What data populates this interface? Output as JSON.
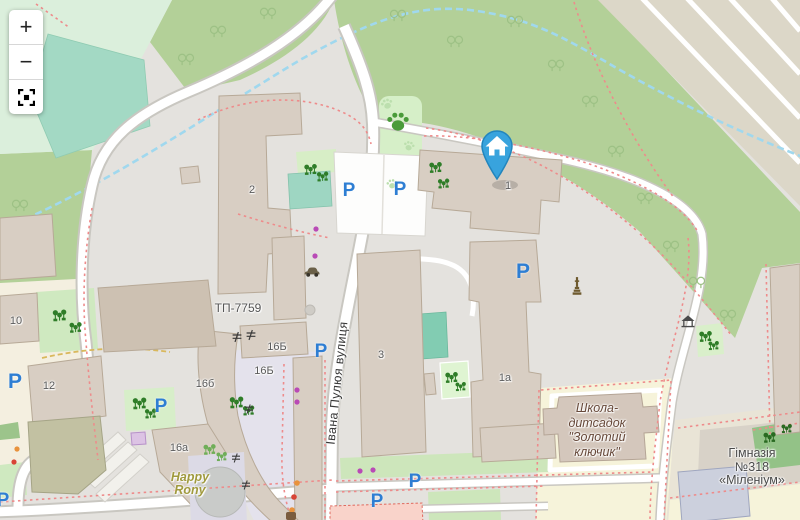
{
  "map": {
    "controls": {
      "zoom_in": "+",
      "zoom_out": "−",
      "fullscreen_icon": "expand"
    },
    "street_label": "Івана Пулюя вулиця",
    "substation_label": "ТП-7759",
    "school_label_lines": [
      "Школа-",
      "дитсадок",
      "\"Золотий",
      "ключик\""
    ],
    "gymnasium_label_lines": [
      "Гімназія",
      "№318",
      "«Міленіум»"
    ],
    "playground_label_lines": [
      "Happy",
      "Rony"
    ],
    "building_numbers": {
      "b1": "1",
      "b2": "2",
      "b3": "3",
      "b1a": "1а",
      "b10": "10",
      "b12": "12",
      "b16b_upper": "16Б",
      "b16b_lower": "16Б",
      "b16b_small": "16б",
      "b16a": "16а"
    },
    "parking_letter": "P",
    "colors": {
      "marker_blue": "#38a3dd",
      "parking_blue": "#2e7ed3",
      "park_green": "#b3d098",
      "building_fill": "#d8cec3",
      "water_teal": "#9ed6c2",
      "fence_red": "#ee8b8b"
    }
  }
}
